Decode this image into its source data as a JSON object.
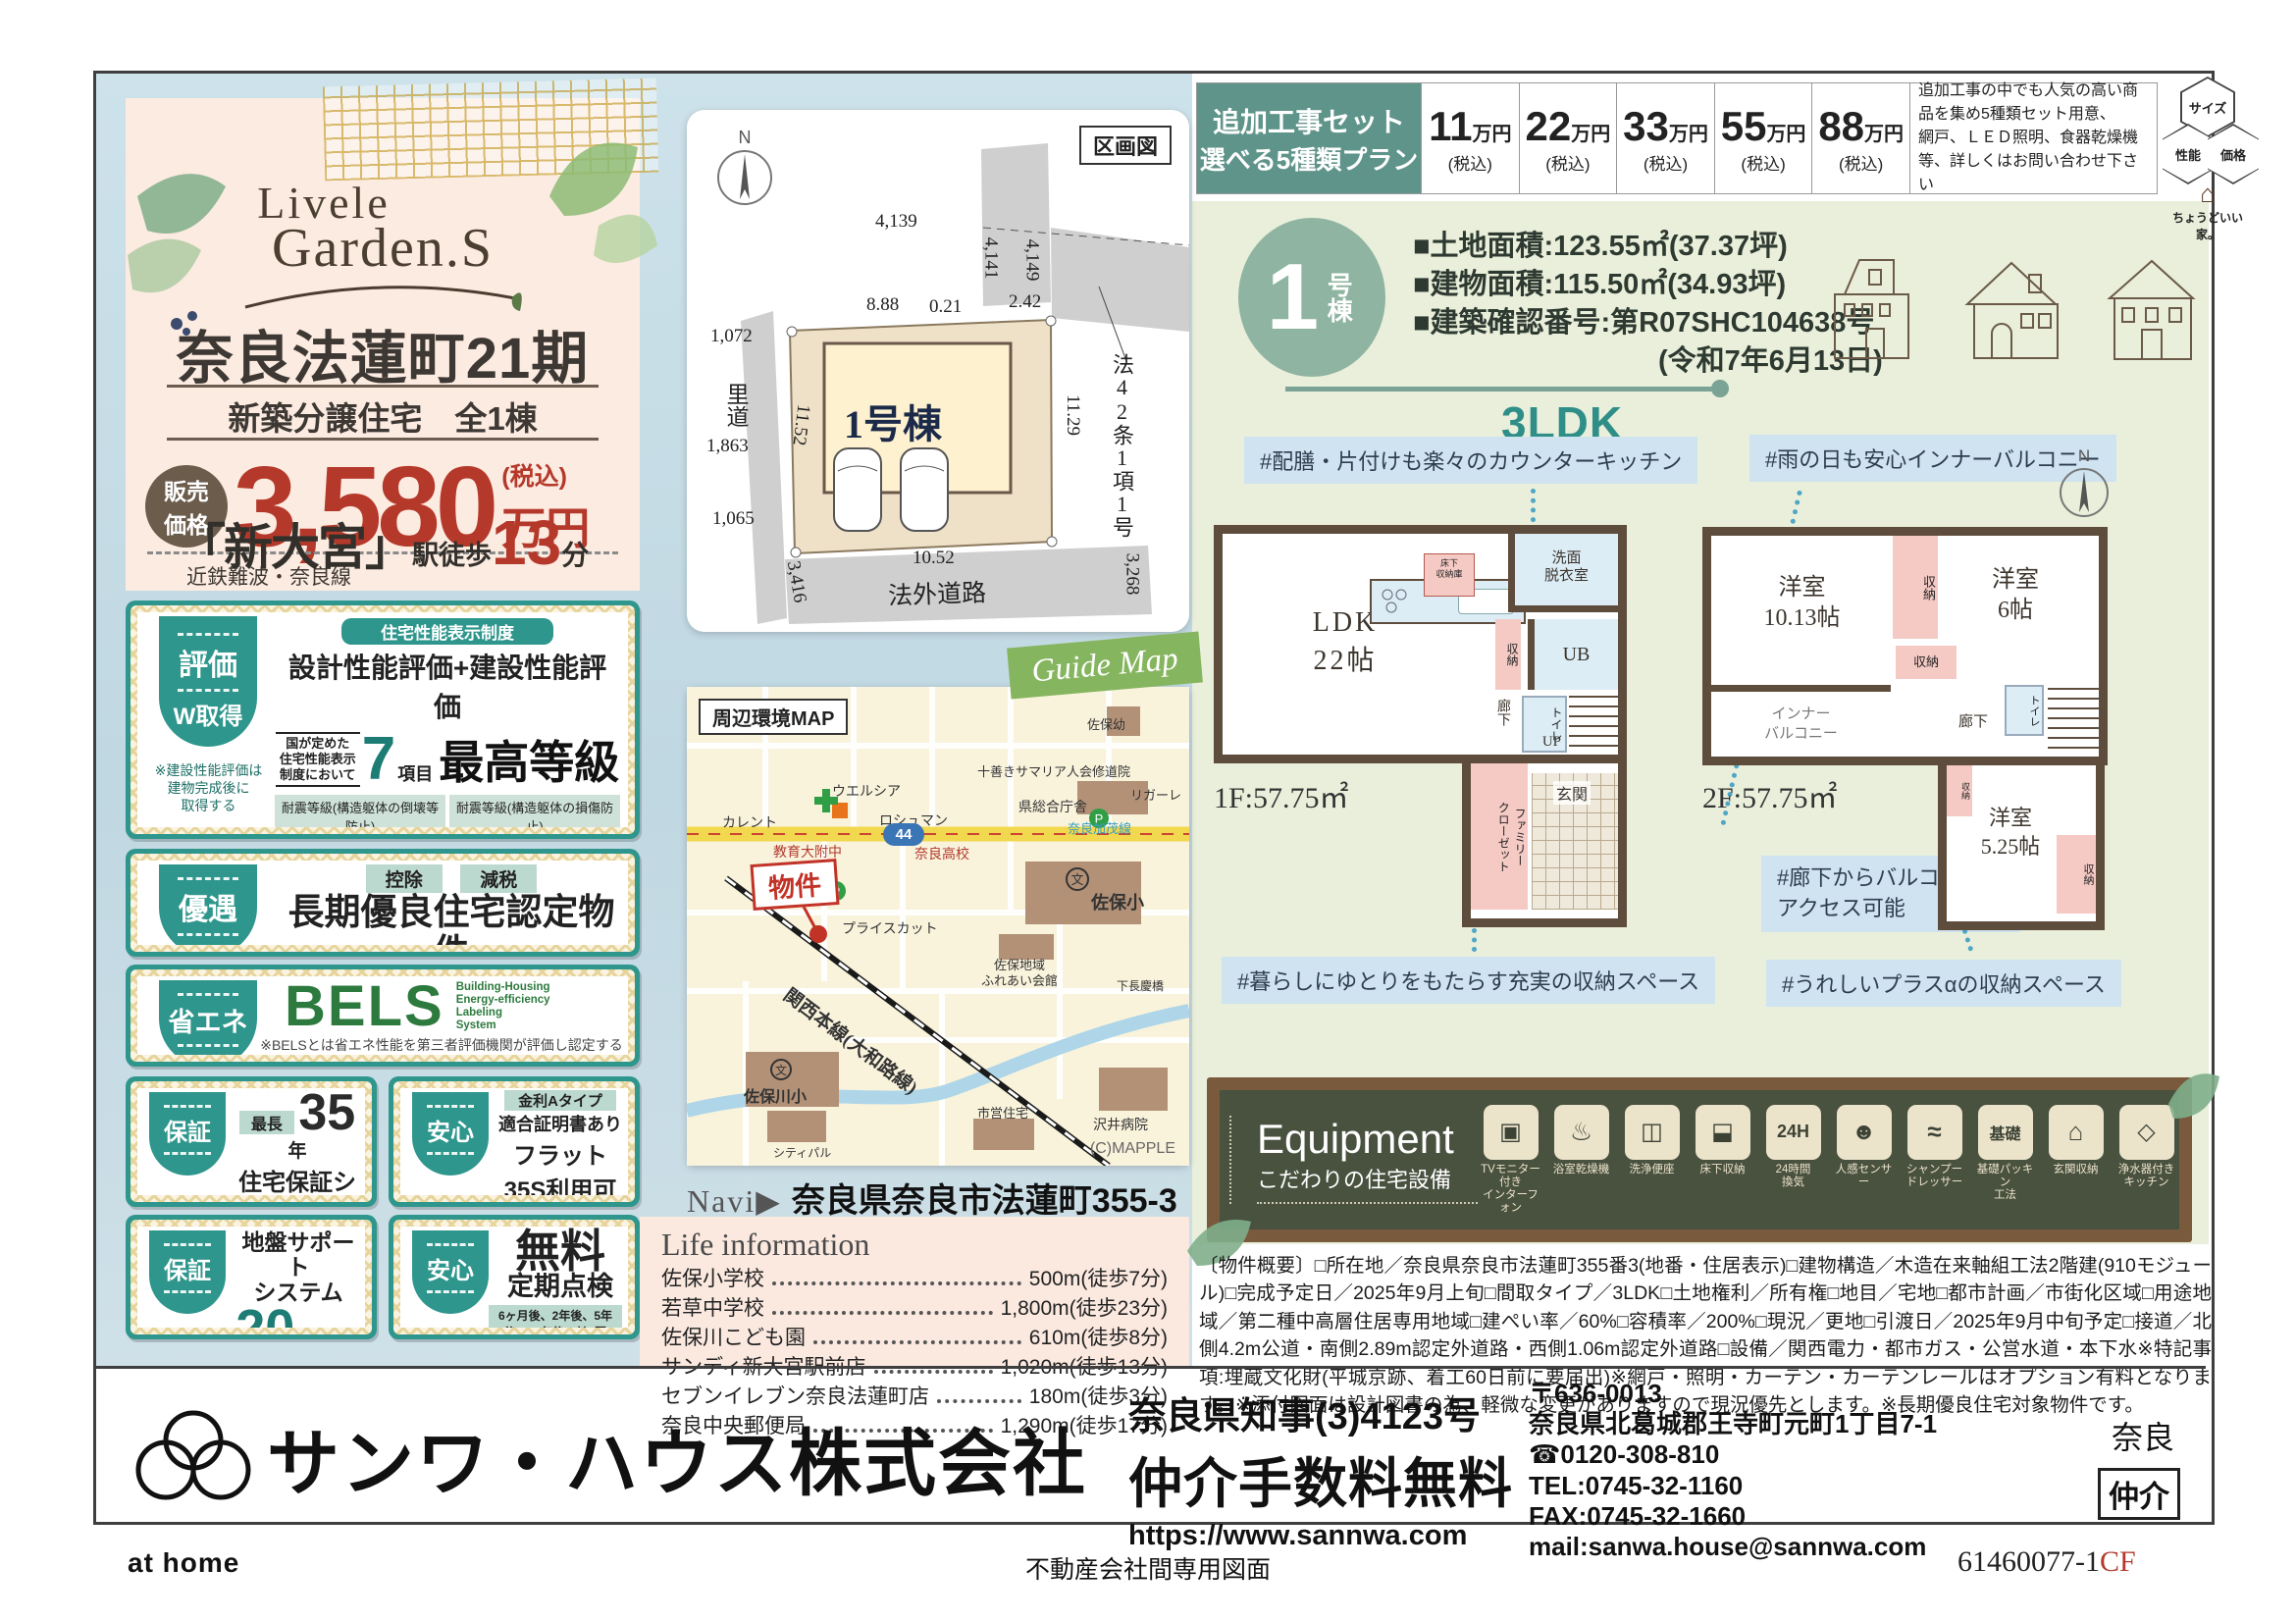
{
  "topbar": {
    "label1": "追加工事セット",
    "label2": "選べる5種類プラン",
    "prices": [
      {
        "amount": "11",
        "unit": "万円",
        "tax": "(税込)"
      },
      {
        "amount": "22",
        "unit": "万円",
        "tax": "(税込)"
      },
      {
        "amount": "33",
        "unit": "万円",
        "tax": "(税込)"
      },
      {
        "amount": "55",
        "unit": "万円",
        "tax": "(税込)"
      },
      {
        "amount": "88",
        "unit": "万円",
        "tax": "(税込)"
      }
    ],
    "note": "追加工事の中でも人気の高い商品を集め5種類セット用意、\n網戸、ＬＥＤ照明、食器乾燥機等、詳しくはお問い合わせ下さい",
    "hex": {
      "h1": "サイズ",
      "h2": "性能",
      "h3": "価格",
      "caption": "ちょうどいい家。"
    }
  },
  "hero": {
    "brand1": "Livele",
    "brand2": "Garden.S",
    "title": "奈良法蓮町21期",
    "subtitle": "新築分譲住宅　全1棟",
    "price_badge1": "販売",
    "price_badge2": "価格",
    "price": "3,580",
    "tax": "(税込)",
    "unit": "万円",
    "rail": "近鉄難波・奈良線",
    "station": "「新大宮」",
    "walk": "駅徒歩",
    "minutes": "13",
    "min_unit": "分"
  },
  "plot": {
    "title": "区画図",
    "north": "N",
    "unit": "1号棟",
    "rido": "里道",
    "road": "法外道路",
    "law": "法42条1項1号",
    "d1": "4,139",
    "d2": "4,141",
    "d3": "4,149",
    "d4": "8.88",
    "d5": "0.21",
    "d6": "2.42",
    "d7": "1,072",
    "d8": "1,863",
    "d9": "1,065",
    "d10": "11.52",
    "d11": "11.29",
    "d12": "10.52",
    "d13": "3,416",
    "d14": "3,268"
  },
  "badges": {
    "hyoka": {
      "tab": "評価",
      "tab2": "W取得",
      "head": "住宅性能表示制度",
      "main": "設計性能評価+建設性能評価",
      "small": "国が定めた\n住宅性能表示\n制度において",
      "seven": "7",
      "komoku": "項目",
      "grade": "最高等級",
      "g1": "耐震等級(構造躯体の倒壊等防止)",
      "g2": "耐震等級(構造躯体の損傷防止)",
      "g3": "耐風等級",
      "g4": "劣化対策等級",
      "g5": "ホルムアルデヒド等級(内装及び天井裏等)",
      "g6": "維持管理対策等級",
      "g7": "一次エネルギー消費量等級",
      "note": "※建設性能評価は\n建物完成後に\n取得する"
    },
    "yugu": {
      "tab": "優遇",
      "chip1": "控除",
      "chip2": "減税",
      "main": "長期優良住宅認定物件",
      "note": "※一部の建物は対象外の場合があります。"
    },
    "shoene": {
      "tab": "省エネ",
      "bels": "BELS",
      "bels_sub": "Building-Housing\nEnergy-efficiency\nLabeling\nSystem",
      "note": "※BELSとは省エネ性能を第三者評価機関が評価し認定する制度です。"
    },
    "hosho35": {
      "tab": "保証",
      "chip": "最長",
      "big": "35",
      "unit": "年",
      "main": "住宅保証システム",
      "note": "※お引渡しから5年以降、5年ごとに\n有償修繕工事を行うことが条件となります。"
    },
    "flat35": {
      "tab": "安心",
      "chip": "金利Aタイプ",
      "sub": "適合証明書あり",
      "main": "フラット35S利用可",
      "note": "※一連の事務手数料として、物件引き渡し時に\n88,000円(税込)をお支払いいただきます。"
    },
    "jiban": {
      "tab": "保証",
      "main": "地盤サポート\nシステム",
      "big": "20",
      "unit": "年保証"
    },
    "tenken": {
      "tab": "安心",
      "big": "無料",
      "sub": "定期点検",
      "note": "6ヶ月後、2年後、5年後、10年後の計4回"
    }
  },
  "map": {
    "label": "周辺環境MAP",
    "ribbon": "Guide Map",
    "marker": "物件",
    "credit": "(C)MAPPLE",
    "route": "44",
    "route_name": "奈良加茂線",
    "rail_name": "関西本線(大和路線)",
    "lm1": "カレント",
    "lm2": "ウエルシア",
    "lm3": "ロシュマン",
    "lm4": "教育大附中",
    "lm5": "奈良高校",
    "lm6": "プライスカット",
    "lm7": "佐保小",
    "lm8": "佐保幼",
    "lm9": "十善きサマリア人会修道院",
    "lm10": "リガーレ",
    "lm11": "県総合庁舎",
    "lm12": "佐保地域\nふれあい会館",
    "lm13": "下長慶橋",
    "lm14": "佐保川小",
    "lm15": "シティパル",
    "lm16": "市営住宅",
    "lm17": "沢井病院",
    "navi_label": "Navi▶",
    "navi_address": "奈良県奈良市法蓮町355-3"
  },
  "life": {
    "title": "Life information",
    "items": [
      {
        "name": "佐保小学校",
        "value": "500m(徒歩7分)"
      },
      {
        "name": "若草中学校",
        "value": "1,800m(徒歩23分)"
      },
      {
        "name": "佐保川こども園",
        "value": "610m(徒歩8分)"
      },
      {
        "name": "サンディ新大宮駅前店",
        "value": "1,020m(徒歩13分)"
      },
      {
        "name": "セブンイレブン奈良法蓮町店",
        "value": "180m(徒歩3分)"
      },
      {
        "name": "奈良中央郵便局",
        "value": "1,290m(徒歩17分)"
      }
    ]
  },
  "unit": {
    "num": "1",
    "suffix": "号棟",
    "spec1": "■土地面積:123.55㎡(37.37坪)",
    "spec2": "■建物面積:115.50㎡(34.93坪)",
    "spec3": "■建築確認番号:第R07SHC104638号",
    "spec4": "(令和7年6月13日)",
    "plan": "3LDK"
  },
  "plans": {
    "callout_kitchen": "#配膳・片付けも楽々のカウンターキッチン",
    "callout_balcony": "#雨の日も安心インナーバルコニー",
    "callout_storage1": "#暮らしにゆとりをもたらす充実の収納スペース",
    "callout_corridor": "#廊下からバルコニーへ\nアクセス可能",
    "callout_storage2": "#うれしいプラスαの収納スペース",
    "north": "N",
    "f1": {
      "area": "1F:57.75㎡",
      "ldk": "LDK\n22帖",
      "senmen": "洗面\n脱衣室",
      "ub": "UB",
      "shuno": "収納",
      "toilet": "トイレ",
      "rouka": "廊下",
      "up": "UP",
      "famiclo": "ファミリー\nクローゼット",
      "genkan": "玄関",
      "yukashita": "床下\n収納庫"
    },
    "f2": {
      "area": "2F:57.75㎡",
      "room1": "洋室\n10.13帖",
      "room2": "洋室\n6帖",
      "room3": "洋室\n5.25帖",
      "shuno": "収納",
      "inner": "インナー\nバルコニー",
      "rouka": "廊下",
      "dn": "DN",
      "toilet": "トイレ"
    }
  },
  "equipment": {
    "title": "Equipment",
    "subtitle": "こだわりの住宅設備",
    "items": [
      {
        "label": "TVモニター付き\nインターフォン",
        "glyph": "▣"
      },
      {
        "label": "浴室乾燥機",
        "glyph": "♨"
      },
      {
        "label": "洗浄便座",
        "glyph": "◫"
      },
      {
        "label": "床下収納",
        "glyph": "⬓"
      },
      {
        "label": "24時間\n換気",
        "glyph": "24H"
      },
      {
        "label": "人感センサー",
        "glyph": "☻"
      },
      {
        "label": "シャンプー\nドレッサー",
        "glyph": "≈"
      },
      {
        "label": "基礎パッキン\n工法",
        "glyph": "基礎"
      },
      {
        "label": "玄関収納",
        "glyph": "⌂"
      },
      {
        "label": "浄水器付き\nキッチン",
        "glyph": "◇"
      }
    ]
  },
  "overview": "〔物件概要〕□所在地／奈良県奈良市法蓮町355番3(地番・住居表示)□建物構造／木造在来軸組工法2階建(910モジュール)□完成予定日／2025年9月上旬□間取タイプ／3LDK□土地権利／所有権□地目／宅地□都市計画／市街化区域□用途地域／第二種中高層住居専用地域□建ぺい率／60%□容積率／200%□現況／更地□引渡日／2025年9月中旬予定□接道／北側4.2m公道・南側2.89m認定外道路・西側1.06m認定外道路□設備／関西電力・都市ガス・公営水道・本下水※特記事項:埋蔵文化財(平城京跡、着工60日前に要届出)※網戸・照明・カーテン・カーテンレールはオプション有料となります。※添付図面は設計図書の為、軽微な変更がありますので現況優先とします。※長期優良住宅対象物件です。",
  "company": {
    "name": "サンワ・ハウス株式会社",
    "license": "奈良県知事(3)4123号",
    "fee": "仲介手数料無料",
    "url": "https://www.sannwa.com",
    "postal": "〒636-0013",
    "address": "奈良県北葛城郡王寺町元町1丁目7-1",
    "freedial": "☎0120-308-810",
    "tel": "TEL:0745-32-1160",
    "fax": "FAX:0745-32-1660",
    "mail": "mail:sanwa.house@sannwa.com",
    "branch": "奈良",
    "type": "仲介"
  },
  "footer": {
    "athome": "at home",
    "center": "不動産会社間専用図面",
    "code": "61460077-1",
    "code_suffix": "CF"
  }
}
